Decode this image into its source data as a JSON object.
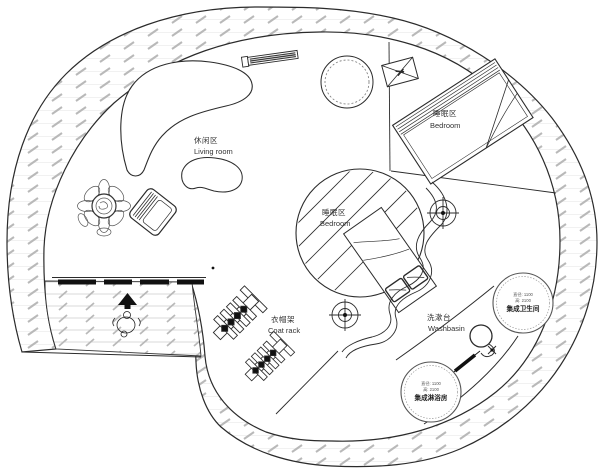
{
  "labels": {
    "living_room": {
      "zh": "休闲区",
      "en": "Living room"
    },
    "bedroom_upper": {
      "zh": "睡眠区",
      "en": "Bedroom"
    },
    "bedroom_center": {
      "zh": "睡眠区",
      "en": "Bedroom"
    },
    "coat_rack": {
      "zh": "衣帽架",
      "en": "Coat rack"
    },
    "washbasin": {
      "zh": "洗漱台",
      "en": "Washbasin"
    },
    "bathroom_pod": {
      "spec_diameter": "直径: 1100",
      "spec_height": "高: 2100",
      "name": "集成卫生间"
    },
    "shower_pod": {
      "spec_diameter": "直径: 1100",
      "spec_height": "高: 2100",
      "name": "集成淋浴房"
    }
  },
  "colors": {
    "line": "#2b2b2b",
    "hatch": "#b9b9b9",
    "deck_line": "#cccccc",
    "text": "#333333",
    "background": "#ffffff"
  }
}
